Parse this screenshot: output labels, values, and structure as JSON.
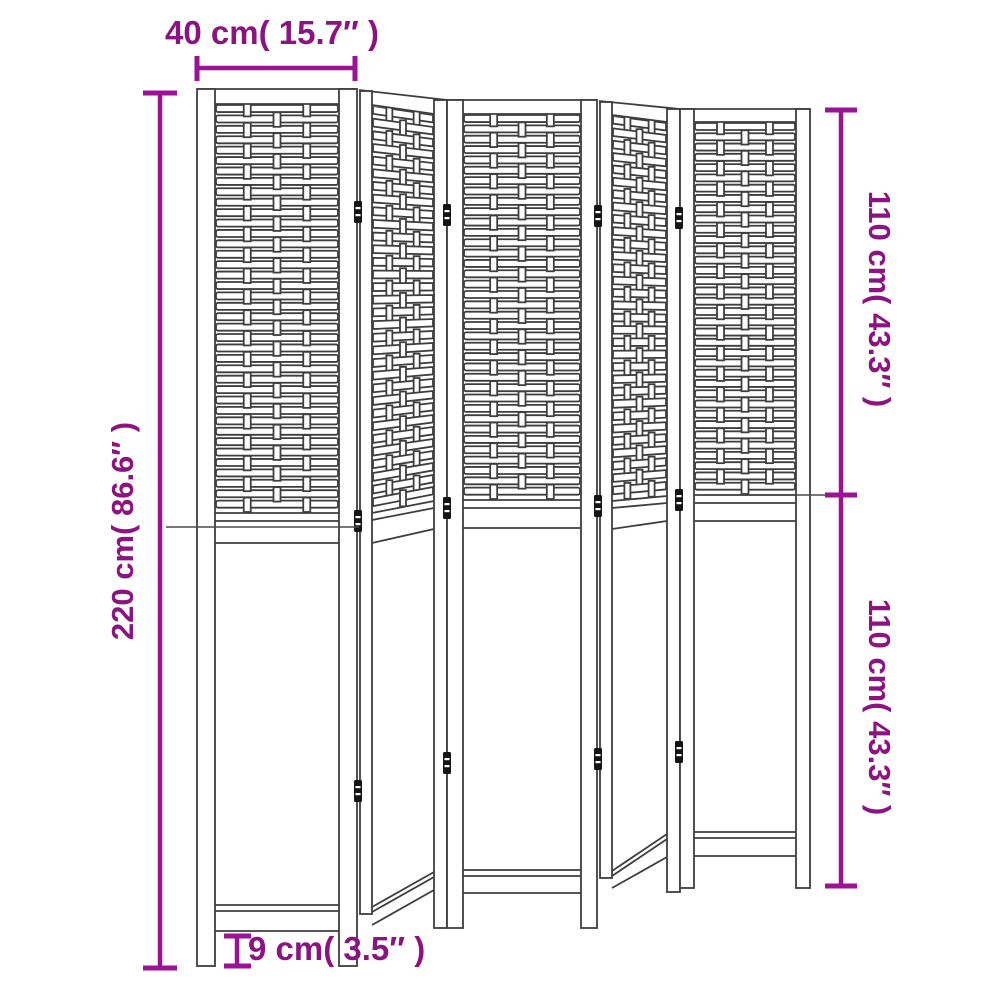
{
  "illustration": {
    "subject": "5-panel folding room divider line drawing",
    "panel_count": 5
  },
  "dimensions": {
    "panel_width": "40 cm( 15.7″ )",
    "total_height": "220 cm( 86.6″ )",
    "upper_section_height": "110 cm( 43.3″ )",
    "lower_section_height": "110 cm( 43.3″ )",
    "leg_height": "9 cm( 3.5″ )"
  },
  "colors": {
    "dimension_text": "#8b1480",
    "dimension_line": "#9c1295",
    "line_art": "#3e3e3e",
    "background": "#ffffff"
  }
}
